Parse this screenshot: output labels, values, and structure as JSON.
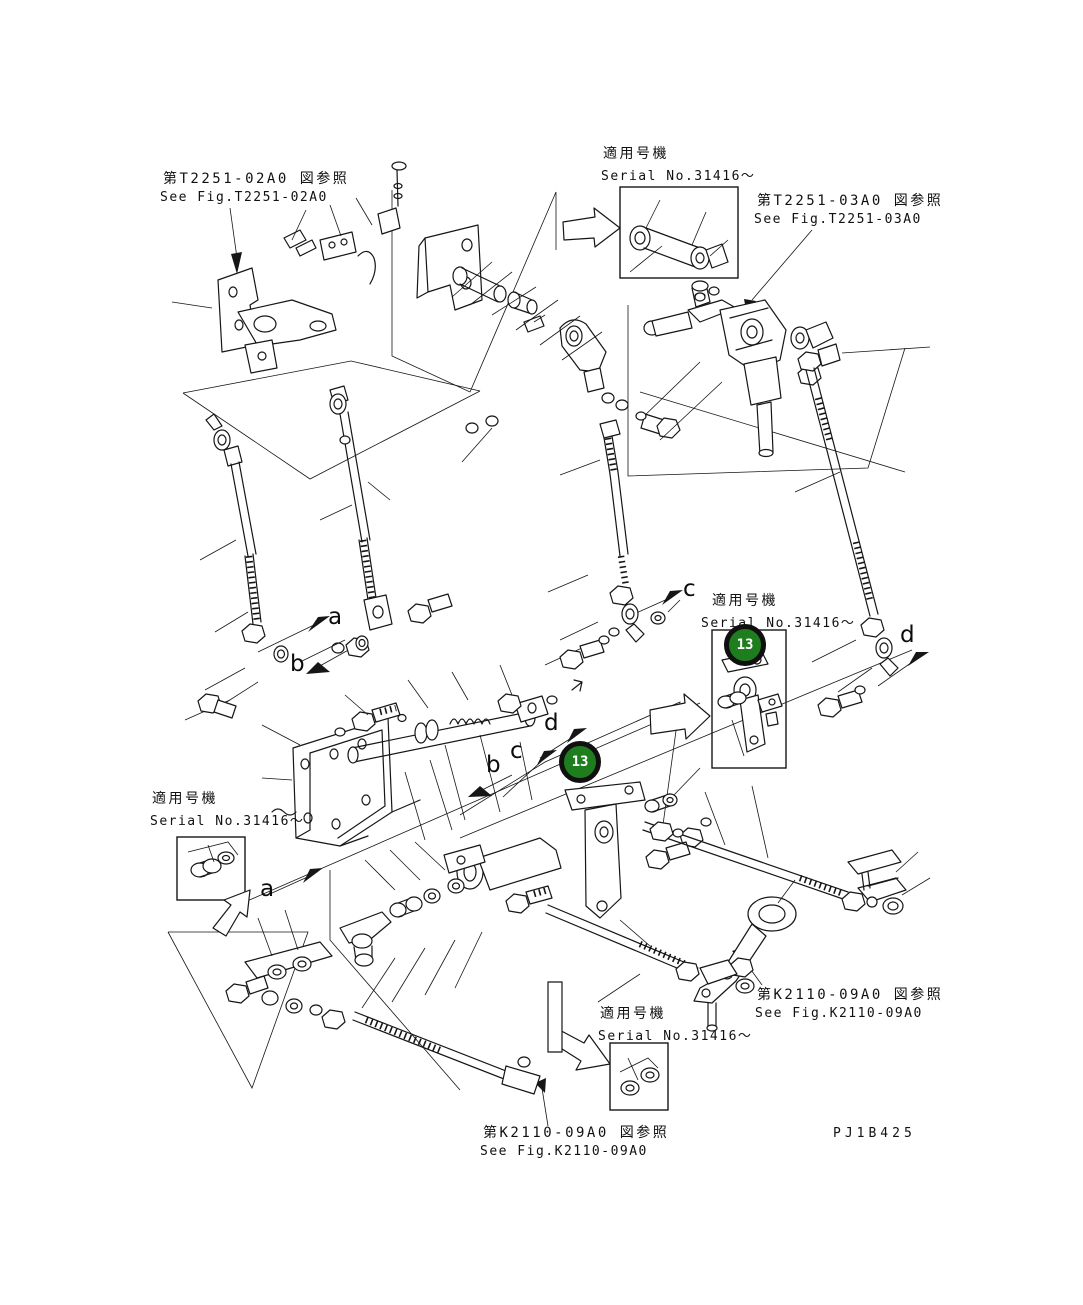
{
  "figure": {
    "drawing_code": "PJ1B425",
    "callouts": {
      "right_box_badge": "13",
      "center_badge": "13"
    },
    "refs": {
      "t2251_02a0": {
        "jp": "第T2251-02A0 図参照",
        "en": "See Fig.T2251-02A0"
      },
      "t2251_03a0": {
        "jp": "第T2251-03A0 図参照",
        "en": "See Fig.T2251-03A0"
      },
      "k2110_09a0_right": {
        "jp": "第K2110-09A0 図参照",
        "en": "See Fig.K2110-09A0"
      },
      "k2110_09a0_bottom": {
        "jp": "第K2110-09A0 図参照",
        "en": "See Fig.K2110-09A0"
      }
    },
    "serial_notes": {
      "top": {
        "jp": "適用号機",
        "en": "Serial No.31416～"
      },
      "right": {
        "jp": "適用号機",
        "en": "Serial No.31416～"
      },
      "left": {
        "jp": "適用号機",
        "en": "Serial No.31416～"
      },
      "bottom": {
        "jp": "適用号機",
        "en": "Serial No.31416～"
      }
    },
    "section_letters": {
      "a_top": "a",
      "b_top": "b",
      "c_right": "c",
      "d_right": "d",
      "b_mid": "b",
      "c_mid": "c",
      "d_mid": "d",
      "a_bottom": "a"
    },
    "colors": {
      "badge_green": "#1e7e1e",
      "badge_ring": "#101010",
      "line": "#161616",
      "background": "#ffffff"
    }
  }
}
